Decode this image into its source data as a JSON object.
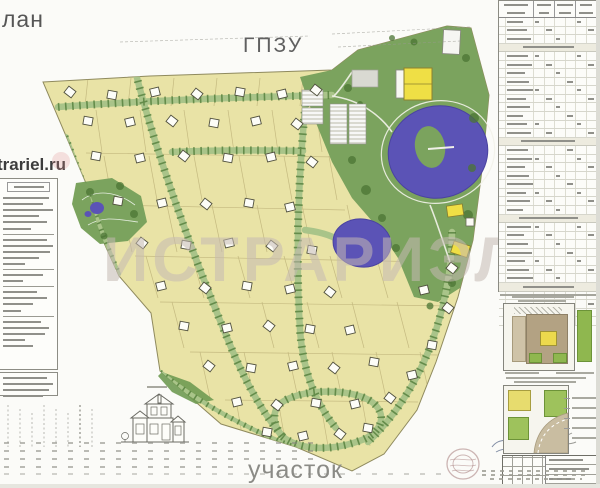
{
  "page": {
    "corner_label": "лан",
    "doc_type_label": "ГПЗУ",
    "bottom_label": "участок"
  },
  "watermarks": {
    "site_url": "trariel.ru",
    "brand": "ИСТРАРИЭЛ"
  },
  "colors": {
    "plots": "#e9e3a6",
    "park": "#7ba35e",
    "road": "#a9c489",
    "road_trees": "#4e7a36",
    "lake": "#5b53b6",
    "building_yellow": "#efdf45",
    "watermark": "#c6bab4",
    "plot_line": "#b9ad74"
  },
  "map": {
    "houses": [
      [
        70,
        92
      ],
      [
        112,
        95
      ],
      [
        155,
        92
      ],
      [
        197,
        94
      ],
      [
        240,
        92
      ],
      [
        282,
        94
      ],
      [
        316,
        90
      ],
      [
        88,
        121
      ],
      [
        130,
        122
      ],
      [
        172,
        121
      ],
      [
        214,
        123
      ],
      [
        256,
        121
      ],
      [
        297,
        124
      ],
      [
        96,
        156
      ],
      [
        140,
        158
      ],
      [
        184,
        156
      ],
      [
        228,
        158
      ],
      [
        271,
        157
      ],
      [
        312,
        162
      ],
      [
        118,
        201
      ],
      [
        162,
        203
      ],
      [
        206,
        204
      ],
      [
        249,
        203
      ],
      [
        290,
        207
      ],
      [
        142,
        243
      ],
      [
        186,
        245
      ],
      [
        229,
        243
      ],
      [
        272,
        246
      ],
      [
        312,
        250
      ],
      [
        161,
        286
      ],
      [
        205,
        288
      ],
      [
        247,
        286
      ],
      [
        290,
        289
      ],
      [
        330,
        292
      ],
      [
        184,
        326
      ],
      [
        227,
        328
      ],
      [
        269,
        326
      ],
      [
        310,
        329
      ],
      [
        350,
        330
      ],
      [
        209,
        366
      ],
      [
        251,
        368
      ],
      [
        293,
        366
      ],
      [
        334,
        368
      ],
      [
        374,
        362
      ],
      [
        237,
        402
      ],
      [
        277,
        405
      ],
      [
        316,
        403
      ],
      [
        355,
        404
      ],
      [
        390,
        398
      ],
      [
        267,
        432
      ],
      [
        303,
        436
      ],
      [
        340,
        434
      ],
      [
        368,
        428
      ],
      [
        424,
        290
      ],
      [
        448,
        308
      ],
      [
        432,
        345
      ],
      [
        412,
        375
      ],
      [
        452,
        268
      ]
    ],
    "plot_bands": [
      [
        78,
        106,
        88,
        330,
        43,
        -3
      ],
      [
        110,
        152,
        96,
        332,
        44,
        6
      ],
      [
        156,
        200,
        104,
        338,
        45,
        8
      ],
      [
        205,
        252,
        122,
        348,
        45,
        10
      ],
      [
        256,
        298,
        146,
        420,
        46,
        12
      ],
      [
        302,
        348,
        172,
        440,
        45,
        12
      ],
      [
        352,
        398,
        200,
        430,
        44,
        10
      ],
      [
        400,
        446,
        236,
        398,
        42,
        8
      ]
    ],
    "plot_hlines": [
      [
        86,
        153,
        336,
        157
      ],
      [
        110,
        205,
        345,
        210
      ],
      [
        135,
        256,
        432,
        262
      ],
      [
        160,
        302,
        452,
        306
      ],
      [
        190,
        352,
        440,
        355
      ],
      [
        225,
        400,
        418,
        402
      ]
    ]
  },
  "legend_panel": {
    "lines": [
      "h",
      46,
      40,
      50,
      36,
      44,
      28,
      0,
      44,
      50,
      47,
      36,
      22,
      0,
      40,
      20,
      0,
      34,
      44,
      30,
      18,
      0,
      38,
      46,
      42,
      22,
      30
    ],
    "lower_lines": [
      44,
      50,
      46,
      40
    ]
  },
  "spec_table": {
    "row_count": 36,
    "band_rows": [
      3,
      14,
      23,
      31
    ]
  }
}
